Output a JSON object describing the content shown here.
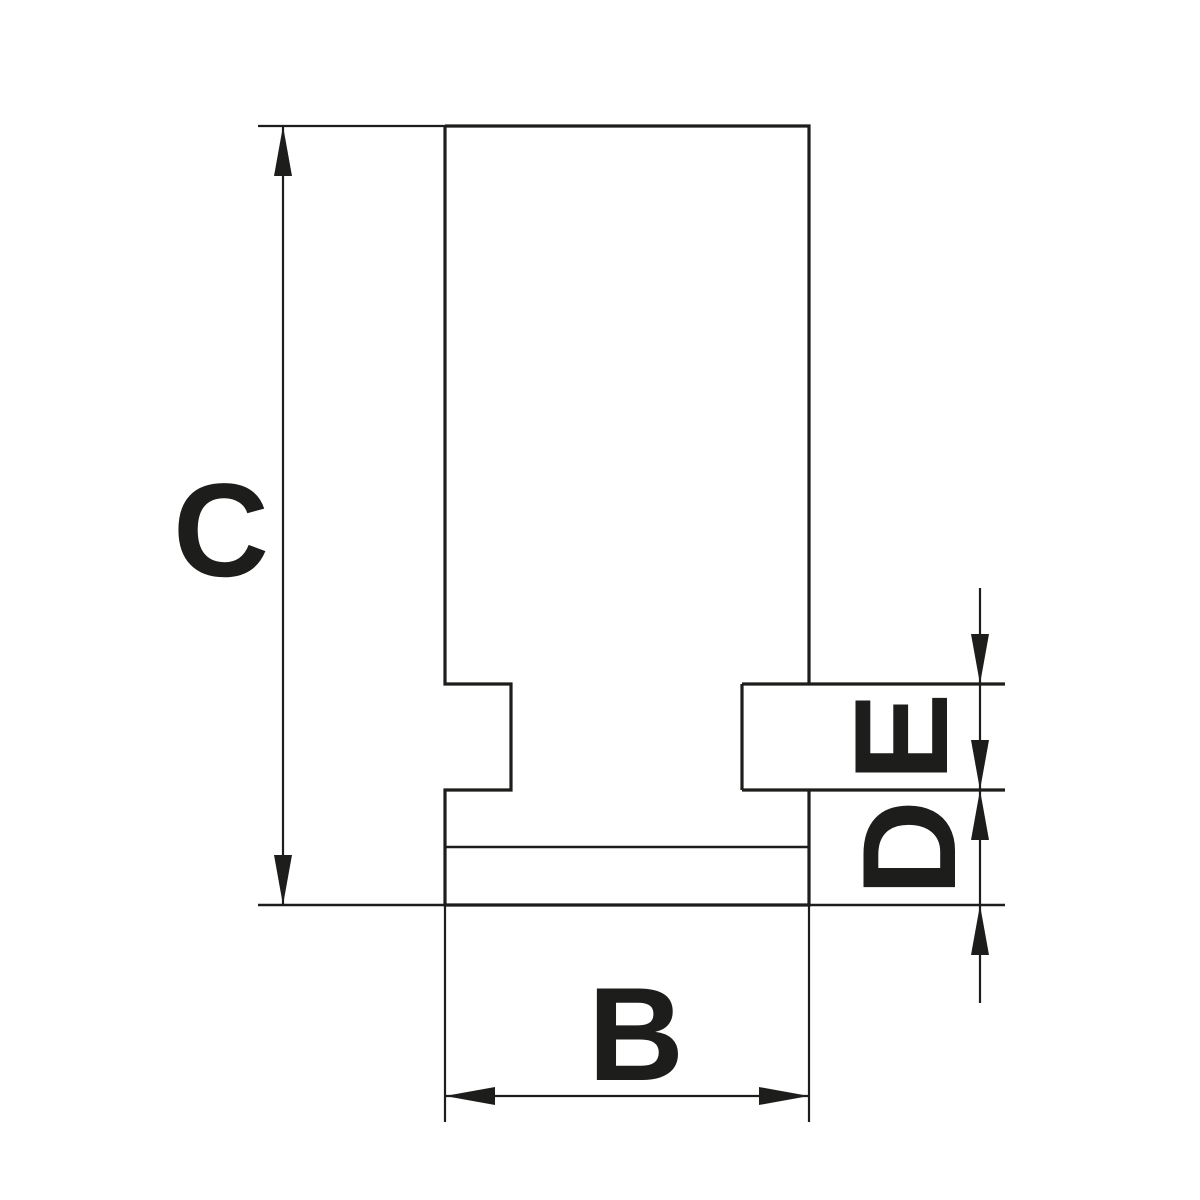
{
  "drawing": {
    "type": "technical-dimension-drawing",
    "background_color": "#ffffff",
    "line_color": "#1d1d1b",
    "dimensions": {
      "overall_height": {
        "label": "C"
      },
      "jaw_width": {
        "label": "B"
      },
      "groove_height": {
        "label": "E"
      },
      "base_height": {
        "label": "D"
      }
    }
  }
}
